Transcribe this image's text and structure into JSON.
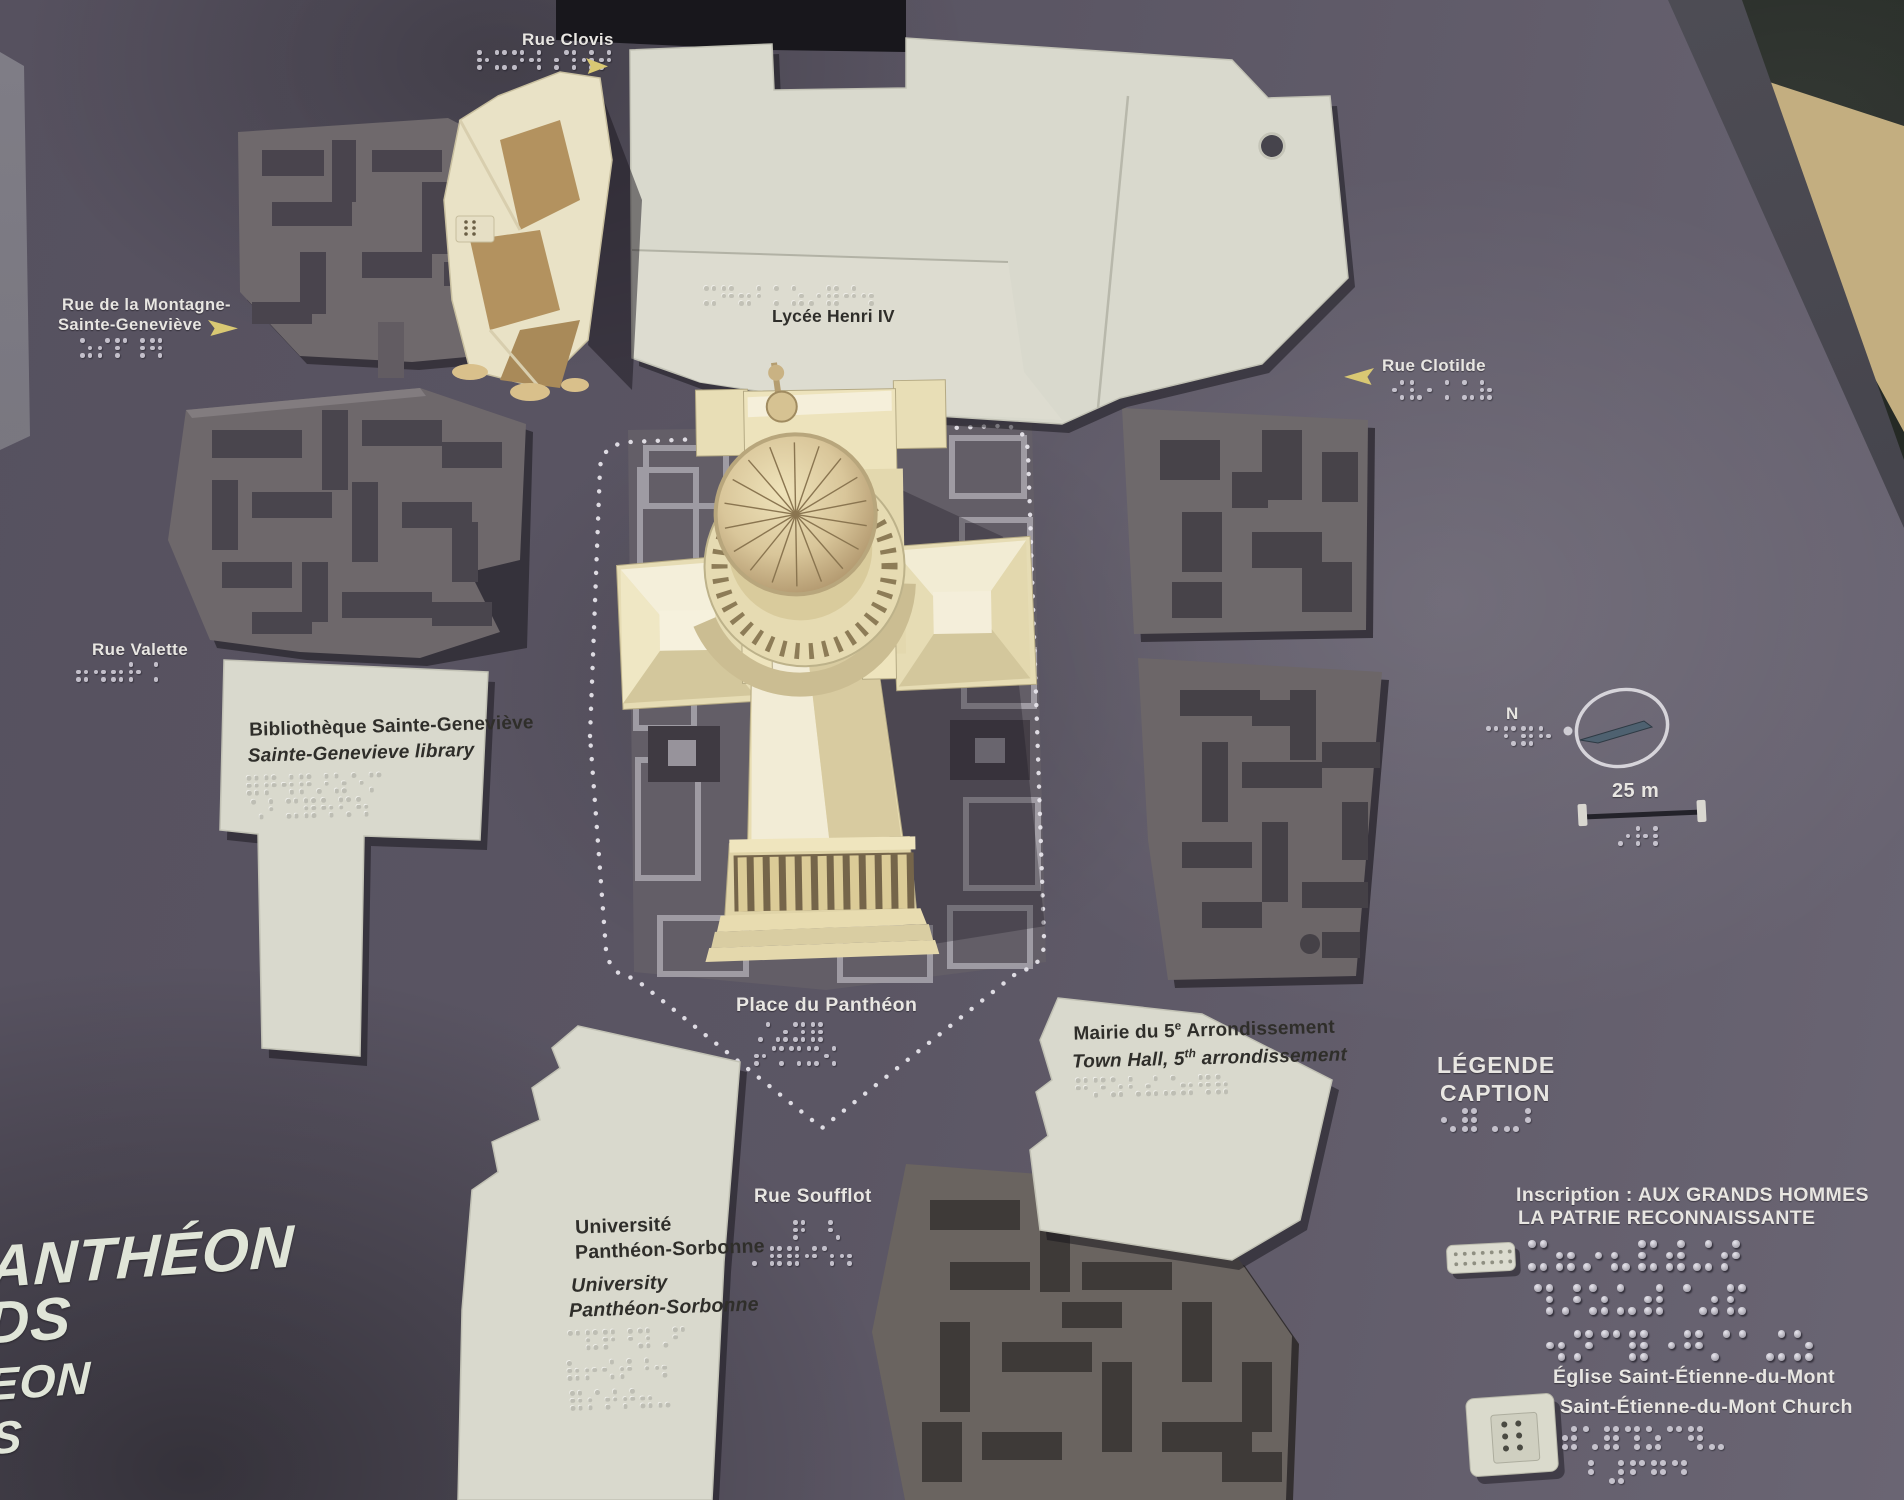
{
  "streets": {
    "clovis": "Rue Clovis",
    "montagne": [
      "Rue de la Montagne-",
      "Sainte-Geneviève"
    ],
    "clotilde": "Rue Clotilde",
    "valette": "Rue Valette",
    "soufflot": "Rue Soufflot"
  },
  "places": {
    "pantheon_square": "Place du Panthéon"
  },
  "buildings": {
    "lycee": "Lycée Henri IV",
    "bibliotheque": [
      "Bibliothèque Sainte-Geneviève",
      "Sainte-Genevieve library"
    ],
    "mairie": {
      "fr": [
        "Mairie du 5",
        "e",
        " Arrondissement"
      ],
      "en": [
        "Town Hall, 5",
        "th",
        " arrondissement"
      ]
    },
    "universite": [
      "Université",
      "Panthéon-Sorbonne",
      "University",
      "Panthéon-Sorbonne"
    ]
  },
  "legend": {
    "title": [
      "LÉGENDE",
      "CAPTION"
    ],
    "inscription": [
      "Inscription : AUX GRANDS HOMMES",
      "LA PATRIE RECONNAISSANTE"
    ],
    "church": [
      "Église Saint-Étienne-du-Mont",
      "Saint-Étienne-du-Mont Church"
    ]
  },
  "compass": {
    "north": "N"
  },
  "scale_bar": {
    "label": "25 m"
  },
  "map_title_fragments": [
    "ANTHÉON",
    "DS",
    "EON",
    "S"
  ],
  "colors": {
    "board": "#575260",
    "plate": "#d9d9cd",
    "model_cream": "#ece3bd",
    "block_gray": "#6e6869",
    "arrow_yellow": "#d9c873",
    "floor_marble": "#2a2f2a",
    "floor_tile": "#c3ae80"
  }
}
